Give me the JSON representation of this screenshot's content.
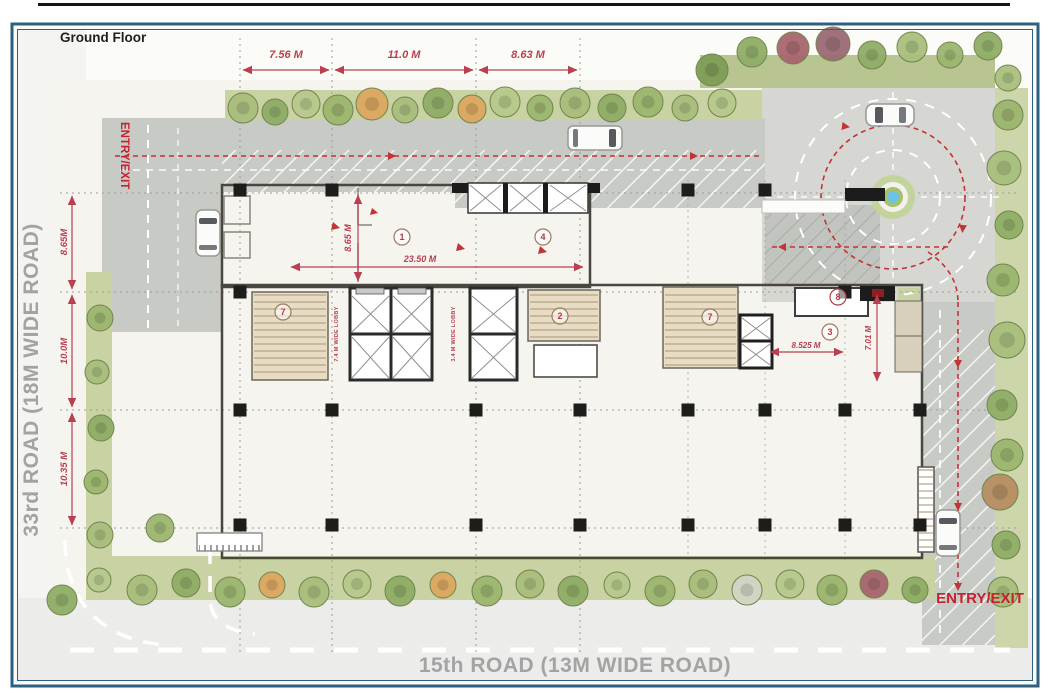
{
  "title": "Ground Floor",
  "roads": {
    "left_label": "33rd ROAD  (18M WIDE ROAD)",
    "bottom_label": "15th ROAD   (13M WIDE ROAD)"
  },
  "entry_exit": {
    "left": "ENTRY/EXIT",
    "bottom_right": "ENTRY/EXIT"
  },
  "dimensions": {
    "top": [
      "7.56 M",
      "11.0 M",
      "8.63 M"
    ],
    "left": [
      "8.65M",
      "10.0M",
      "10.35 M"
    ],
    "interior_hall_depth": "8.65 M",
    "interior_hall_length": "23.50 M",
    "right_wing_width": "8.525 M",
    "right_wing_depth": "7.01 M"
  },
  "lobby_labels": {
    "left": "7.4 M WIDE LOBBY",
    "center": "3.4 M WIDE LOBBY"
  },
  "unit_markers": [
    {
      "n": "1",
      "x": 402,
      "y": 237
    },
    {
      "n": "4",
      "x": 543,
      "y": 237
    },
    {
      "n": "7",
      "x": 283,
      "y": 312
    },
    {
      "n": "2",
      "x": 560,
      "y": 316
    },
    {
      "n": "7",
      "x": 710,
      "y": 317
    },
    {
      "n": "8",
      "x": 838,
      "y": 297
    },
    {
      "n": "3",
      "x": 830,
      "y": 332
    }
  ],
  "colors": {
    "dimension_red": "#b94050",
    "entry_red": "#c8202e",
    "route_red": "#c23333",
    "road_gray": "#c8cac5",
    "site_green": "#c9d2a2",
    "floor_cream": "#f1ead6",
    "frame_blue": "#2d5f7e",
    "fountain_blue": "#6cc4e4"
  },
  "columns": [
    {
      "x": 240,
      "y": 190
    },
    {
      "x": 332,
      "y": 190
    },
    {
      "x": 688,
      "y": 190
    },
    {
      "x": 765,
      "y": 190
    },
    {
      "x": 240,
      "y": 292
    },
    {
      "x": 845,
      "y": 292
    },
    {
      "x": 240,
      "y": 410
    },
    {
      "x": 332,
      "y": 410
    },
    {
      "x": 476,
      "y": 410
    },
    {
      "x": 580,
      "y": 410
    },
    {
      "x": 688,
      "y": 410
    },
    {
      "x": 765,
      "y": 410
    },
    {
      "x": 845,
      "y": 410
    },
    {
      "x": 920,
      "y": 410
    },
    {
      "x": 240,
      "y": 525
    },
    {
      "x": 332,
      "y": 525
    },
    {
      "x": 476,
      "y": 525
    },
    {
      "x": 580,
      "y": 525
    },
    {
      "x": 688,
      "y": 525
    },
    {
      "x": 765,
      "y": 525
    },
    {
      "x": 845,
      "y": 525
    },
    {
      "x": 920,
      "y": 525
    }
  ],
  "trees": [
    {
      "x": 243,
      "y": 108,
      "r": 15,
      "c": "#a9bf7d"
    },
    {
      "x": 275,
      "y": 112,
      "r": 13,
      "c": "#8fae66"
    },
    {
      "x": 306,
      "y": 104,
      "r": 14,
      "c": "#b7c98c"
    },
    {
      "x": 338,
      "y": 110,
      "r": 15,
      "c": "#9cb66f"
    },
    {
      "x": 372,
      "y": 104,
      "r": 16,
      "c": "#dca75f"
    },
    {
      "x": 405,
      "y": 110,
      "r": 13,
      "c": "#a9bf7d"
    },
    {
      "x": 438,
      "y": 103,
      "r": 15,
      "c": "#8fae66"
    },
    {
      "x": 472,
      "y": 109,
      "r": 14,
      "c": "#dca75f"
    },
    {
      "x": 505,
      "y": 102,
      "r": 15,
      "c": "#b7c98c"
    },
    {
      "x": 540,
      "y": 108,
      "r": 13,
      "c": "#9cb66f"
    },
    {
      "x": 575,
      "y": 103,
      "r": 15,
      "c": "#a9bf7d"
    },
    {
      "x": 612,
      "y": 108,
      "r": 14,
      "c": "#8fae66"
    },
    {
      "x": 648,
      "y": 102,
      "r": 15,
      "c": "#9cb66f"
    },
    {
      "x": 685,
      "y": 108,
      "r": 13,
      "c": "#a9bf7d"
    },
    {
      "x": 722,
      "y": 103,
      "r": 14,
      "c": "#b7c98c"
    },
    {
      "x": 712,
      "y": 70,
      "r": 16,
      "c": "#7e9e55"
    },
    {
      "x": 752,
      "y": 52,
      "r": 15,
      "c": "#8fae66"
    },
    {
      "x": 793,
      "y": 48,
      "r": 16,
      "c": "#a8666f"
    },
    {
      "x": 833,
      "y": 44,
      "r": 17,
      "c": "#9b6b75"
    },
    {
      "x": 872,
      "y": 55,
      "r": 14,
      "c": "#8fae66"
    },
    {
      "x": 912,
      "y": 47,
      "r": 15,
      "c": "#a9bf7d"
    },
    {
      "x": 950,
      "y": 55,
      "r": 13,
      "c": "#9cb66f"
    },
    {
      "x": 988,
      "y": 46,
      "r": 14,
      "c": "#8fae66"
    },
    {
      "x": 1008,
      "y": 78,
      "r": 13,
      "c": "#a9bf7d"
    },
    {
      "x": 1008,
      "y": 115,
      "r": 15,
      "c": "#9cb66f"
    },
    {
      "x": 1004,
      "y": 168,
      "r": 17,
      "c": "#a9bf7d"
    },
    {
      "x": 1009,
      "y": 225,
      "r": 14,
      "c": "#8fae66"
    },
    {
      "x": 1003,
      "y": 280,
      "r": 16,
      "c": "#9cb66f"
    },
    {
      "x": 1007,
      "y": 340,
      "r": 18,
      "c": "#a9bf7d"
    },
    {
      "x": 1002,
      "y": 405,
      "r": 15,
      "c": "#8fae66"
    },
    {
      "x": 1007,
      "y": 455,
      "r": 16,
      "c": "#9cb66f"
    },
    {
      "x": 1000,
      "y": 492,
      "r": 18,
      "c": "#b78f62"
    },
    {
      "x": 1006,
      "y": 545,
      "r": 14,
      "c": "#8fae66"
    },
    {
      "x": 1003,
      "y": 592,
      "r": 15,
      "c": "#a9bf7d"
    },
    {
      "x": 100,
      "y": 318,
      "r": 13,
      "c": "#9cb66f"
    },
    {
      "x": 97,
      "y": 372,
      "r": 12,
      "c": "#a9bf7d"
    },
    {
      "x": 101,
      "y": 428,
      "r": 13,
      "c": "#8fae66"
    },
    {
      "x": 96,
      "y": 482,
      "r": 12,
      "c": "#9cb66f"
    },
    {
      "x": 100,
      "y": 535,
      "r": 13,
      "c": "#a9bf7d"
    },
    {
      "x": 99,
      "y": 580,
      "r": 12,
      "c": "#b7c98c"
    },
    {
      "x": 160,
      "y": 528,
      "r": 14,
      "c": "#9cb66f"
    },
    {
      "x": 62,
      "y": 600,
      "r": 15,
      "c": "#8fae66"
    },
    {
      "x": 142,
      "y": 590,
      "r": 15,
      "c": "#a9bf7d"
    },
    {
      "x": 186,
      "y": 583,
      "r": 14,
      "c": "#8fae66"
    },
    {
      "x": 230,
      "y": 592,
      "r": 15,
      "c": "#9cb66f"
    },
    {
      "x": 272,
      "y": 585,
      "r": 13,
      "c": "#dca75f"
    },
    {
      "x": 314,
      "y": 592,
      "r": 15,
      "c": "#a9bf7d"
    },
    {
      "x": 357,
      "y": 584,
      "r": 14,
      "c": "#b7c98c"
    },
    {
      "x": 400,
      "y": 591,
      "r": 15,
      "c": "#8fae66"
    },
    {
      "x": 443,
      "y": 585,
      "r": 13,
      "c": "#dca75f"
    },
    {
      "x": 487,
      "y": 591,
      "r": 15,
      "c": "#9cb66f"
    },
    {
      "x": 530,
      "y": 584,
      "r": 14,
      "c": "#a9bf7d"
    },
    {
      "x": 573,
      "y": 591,
      "r": 15,
      "c": "#8fae66"
    },
    {
      "x": 617,
      "y": 585,
      "r": 13,
      "c": "#b7c98c"
    },
    {
      "x": 660,
      "y": 591,
      "r": 15,
      "c": "#9cb66f"
    },
    {
      "x": 703,
      "y": 584,
      "r": 14,
      "c": "#a9bf7d"
    },
    {
      "x": 747,
      "y": 590,
      "r": 15,
      "c": "#cfd6c4"
    },
    {
      "x": 790,
      "y": 584,
      "r": 14,
      "c": "#b7c98c"
    },
    {
      "x": 832,
      "y": 590,
      "r": 15,
      "c": "#9cb66f"
    },
    {
      "x": 874,
      "y": 584,
      "r": 14,
      "c": "#a8666f"
    },
    {
      "x": 915,
      "y": 590,
      "r": 13,
      "c": "#8fae66"
    }
  ]
}
